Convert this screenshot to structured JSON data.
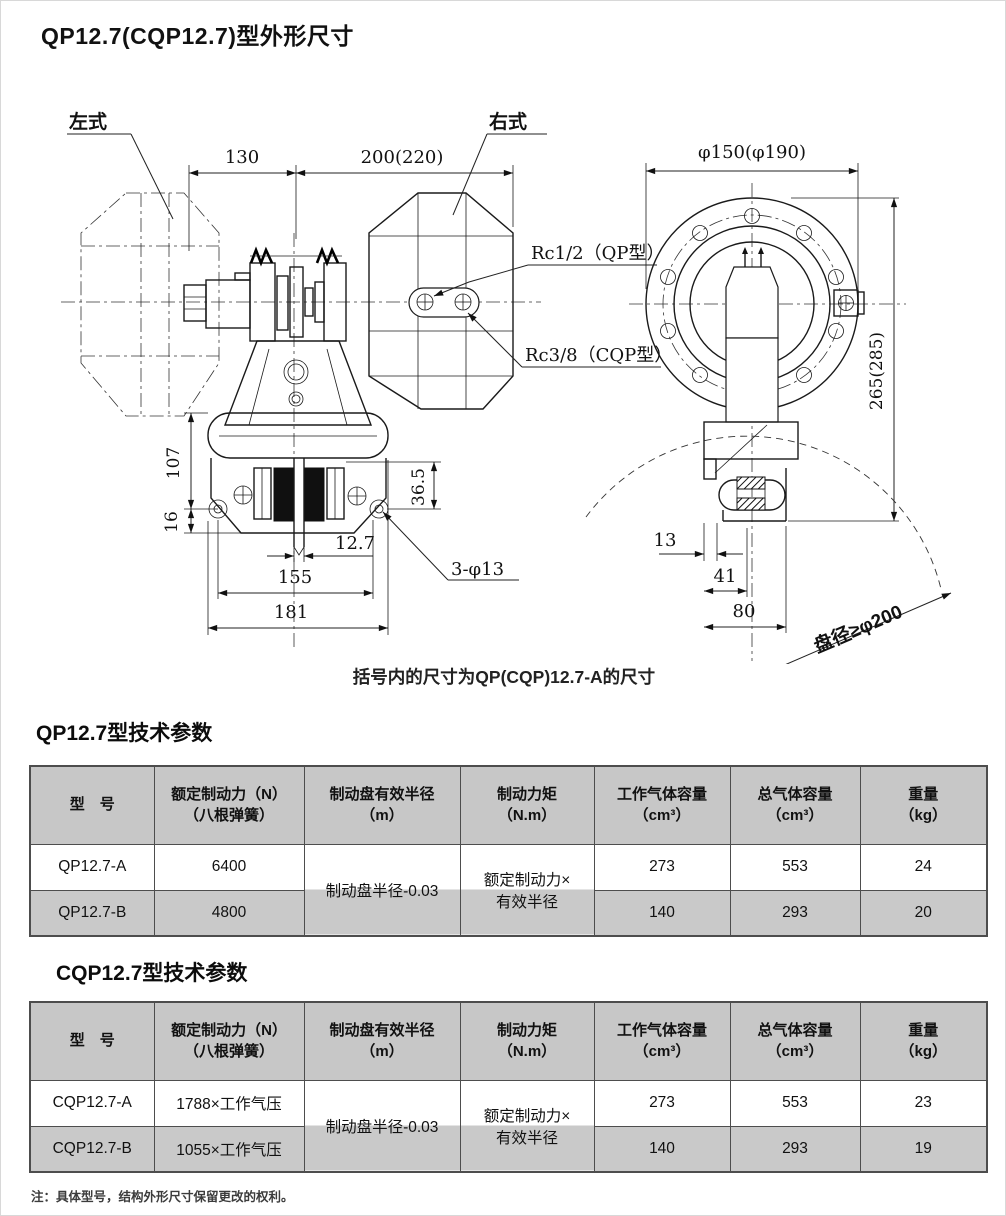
{
  "page": {
    "title": "QP12.7(CQP12.7)型外形尺寸",
    "caption": "括号内的尺寸为QP(CQP)12.7-A的尺寸",
    "note": "注：具体型号，结构外形尺寸保留更改的权利。"
  },
  "drawing": {
    "labels": {
      "left_style": "左式",
      "right_style": "右式",
      "rc_qp": "Rc1/2（QP型）",
      "rc_cqp": "Rc3/8（CQP型）",
      "holes": "3-φ13",
      "disc_dia": "盘径≥φ200"
    },
    "dims": {
      "d130": "130",
      "d200": "200(220)",
      "d107": "107",
      "d16": "16",
      "d36_5": "36.5",
      "d12_7": "12.7",
      "d155": "155",
      "d181": "181",
      "flange": "φ150(φ190)",
      "d265": "265(285)",
      "d13": "13",
      "d41": "41",
      "d80": "80"
    }
  },
  "table1": {
    "title": "QP12.7型技术参数",
    "headers": [
      {
        "l1": "型　号",
        "l2": ""
      },
      {
        "l1": "额定制动力（N）",
        "l2": "（八根弹簧）"
      },
      {
        "l1": "制动盘有效半径",
        "l2": "（m）"
      },
      {
        "l1": "制动力矩",
        "l2": "（N.m）"
      },
      {
        "l1": "工作气体容量",
        "l2": "（cm³）"
      },
      {
        "l1": "总气体容量",
        "l2": "（cm³）"
      },
      {
        "l1": "重量",
        "l2": "（kg）"
      }
    ],
    "merged": {
      "radius": "制动盘半径-0.03",
      "torque1": "额定制动力×",
      "torque2": "有效半径"
    },
    "rows": [
      {
        "model": "QP12.7-A",
        "force": "6400",
        "work": "273",
        "total": "553",
        "weight": "24"
      },
      {
        "model": "QP12.7-B",
        "force": "4800",
        "work": "140",
        "total": "293",
        "weight": "20"
      }
    ]
  },
  "table2": {
    "title": "CQP12.7型技术参数",
    "headers": [
      {
        "l1": "型　号",
        "l2": ""
      },
      {
        "l1": "额定制动力（N）",
        "l2": "（八根弹簧）"
      },
      {
        "l1": "制动盘有效半径",
        "l2": "（m）"
      },
      {
        "l1": "制动力矩",
        "l2": "（N.m）"
      },
      {
        "l1": "工作气体容量",
        "l2": "（cm³）"
      },
      {
        "l1": "总气体容量",
        "l2": "（cm³）"
      },
      {
        "l1": "重量",
        "l2": "（kg）"
      }
    ],
    "merged": {
      "radius": "制动盘半径-0.03",
      "torque1": "额定制动力×",
      "torque2": "有效半径"
    },
    "rows": [
      {
        "model": "CQP12.7-A",
        "force": "1788×工作气压",
        "work": "273",
        "total": "553",
        "weight": "23"
      },
      {
        "model": "CQP12.7-B",
        "force": "1055×工作气压",
        "work": "140",
        "total": "293",
        "weight": "19"
      }
    ]
  }
}
